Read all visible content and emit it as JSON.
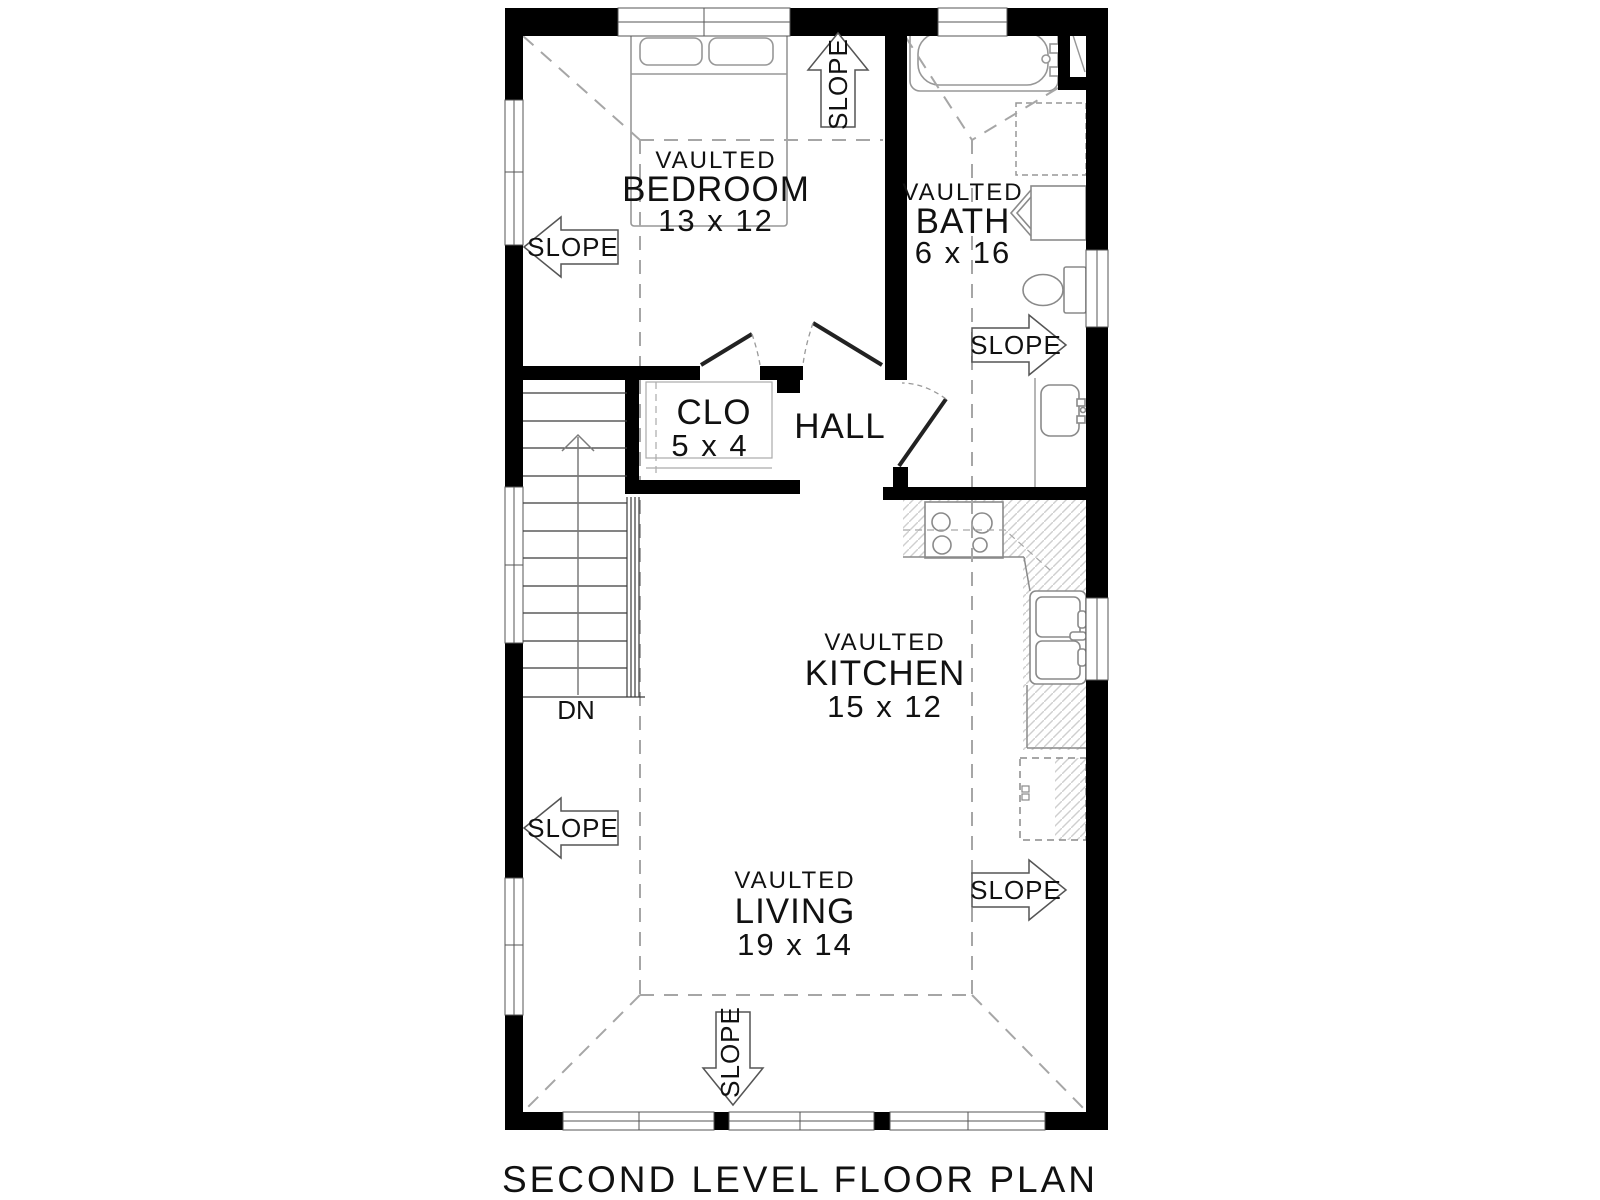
{
  "title": "SECOND LEVEL FLOOR PLAN",
  "rooms": {
    "bedroom": {
      "tag": "VAULTED",
      "name": "BEDROOM",
      "size": "13 x 12"
    },
    "bath": {
      "tag": "VAULTED",
      "name": "BATH",
      "size": "6 x 16"
    },
    "kitchen": {
      "tag": "VAULTED",
      "name": "KITCHEN",
      "size": "15 x 12"
    },
    "living": {
      "tag": "VAULTED",
      "name": "LIVING",
      "size": "19 x 14"
    },
    "closet": {
      "name": "CLO",
      "size": "5 x 4"
    },
    "hall": {
      "name": "HALL"
    }
  },
  "stairs": {
    "label": "DN"
  },
  "slope_arrows": [
    {
      "id": "bedroom-left",
      "label": "SLOPE",
      "direction": "left"
    },
    {
      "id": "bedroom-top",
      "label": "SLOPE",
      "direction": "up"
    },
    {
      "id": "bath-right",
      "label": "SLOPE",
      "direction": "right"
    },
    {
      "id": "living-left",
      "label": "SLOPE",
      "direction": "left"
    },
    {
      "id": "living-right",
      "label": "SLOPE",
      "direction": "right"
    },
    {
      "id": "living-bottom",
      "label": "SLOPE",
      "direction": "down"
    }
  ],
  "colors": {
    "background": "#ffffff",
    "wall": "#000000",
    "furniture_line": "#979797",
    "vault_dash": "#a6a6a6",
    "hatch": "#cfcfcf",
    "text": "#111111"
  }
}
